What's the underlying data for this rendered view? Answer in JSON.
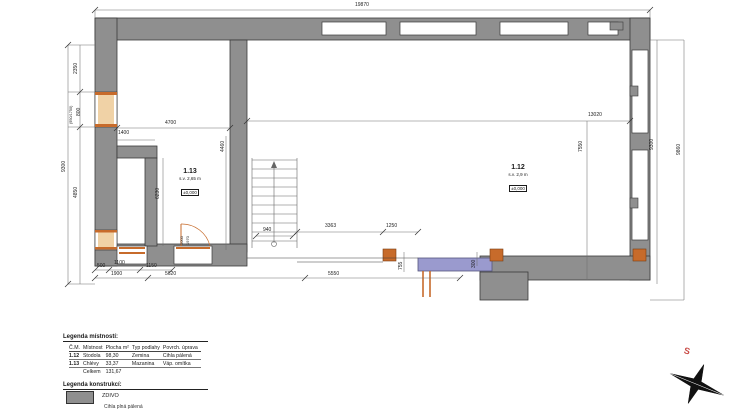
{
  "colors": {
    "wall": "#8f8f8f",
    "wall_outline": "#3a3a3a",
    "brick_accent": "#c76b2b",
    "window_fill": "#f0d2a6",
    "new_masonry_purple": "#9a9ace",
    "north_red": "#c94b46"
  },
  "rooms": [
    {
      "id": "1.13",
      "ceiling": "s.v. 2,65 m",
      "level": "±0,000"
    },
    {
      "id": "1.12",
      "ceiling": "s.v. 2,9 m",
      "level": "±0,000"
    }
  ],
  "dim_labels": [
    {
      "t": "19870",
      "x": 355,
      "y": 3
    },
    {
      "t": "9300",
      "x": 62,
      "y": 172,
      "rot": 1
    },
    {
      "t": "2350",
      "x": 74,
      "y": 74,
      "rot": 1
    },
    {
      "t": "(950/1750)",
      "x": 70,
      "y": 124,
      "rot": 1,
      "size": 3.8
    },
    {
      "t": "800",
      "x": 77,
      "y": 116,
      "rot": 1
    },
    {
      "t": "4850",
      "x": 74,
      "y": 198,
      "rot": 1
    },
    {
      "t": "4700",
      "x": 165,
      "y": 121
    },
    {
      "t": "1400",
      "x": 118,
      "y": 131
    },
    {
      "t": "13020",
      "x": 588,
      "y": 113
    },
    {
      "t": "7550",
      "x": 579,
      "y": 152,
      "rot": 1
    },
    {
      "t": "9300",
      "x": 650,
      "y": 150,
      "rot": 1
    },
    {
      "t": "9860",
      "x": 677,
      "y": 155,
      "rot": 1
    },
    {
      "t": "6230",
      "x": 156,
      "y": 199,
      "rot": 1
    },
    {
      "t": "4460",
      "x": 221,
      "y": 152,
      "rot": 1
    },
    {
      "t": "940",
      "x": 263,
      "y": 228
    },
    {
      "t": "3363",
      "x": 325,
      "y": 224
    },
    {
      "t": "1250",
      "x": 386,
      "y": 224
    },
    {
      "t": "500",
      "x": 97,
      "y": 264
    },
    {
      "t": "1100",
      "x": 114,
      "y": 261
    },
    {
      "t": "1150",
      "x": 146,
      "y": 264
    },
    {
      "t": "1900",
      "x": 111,
      "y": 272
    },
    {
      "t": "5620",
      "x": 165,
      "y": 272
    },
    {
      "t": "5550",
      "x": 328,
      "y": 272
    },
    {
      "t": "755",
      "x": 399,
      "y": 270,
      "rot": 1
    },
    {
      "t": "300",
      "x": 472,
      "y": 268,
      "rot": 1
    },
    {
      "t": "1000",
      "x": 180,
      "y": 245,
      "rot": 1,
      "size": 4
    },
    {
      "t": "1970",
      "x": 186,
      "y": 245,
      "rot": 1,
      "size": 4
    }
  ],
  "legend_rooms": {
    "title": "Legenda místností:",
    "headers": [
      "Č.M.",
      "Místnost",
      "Plocha m²",
      "Typ podlahy",
      "Povrch. úprava"
    ],
    "rows": [
      [
        "1.12",
        "Stodola",
        "98,30",
        "Zemina",
        "Cihla pálená"
      ],
      [
        "1.13",
        "Chlévy",
        "33,37",
        "Mazanina",
        "Váp. omítka"
      ]
    ],
    "total_label": "Celkem",
    "total_value": "131,67"
  },
  "legend_constructions": {
    "title": "Legenda konstrukcí:",
    "items": [
      {
        "label": "ZDIVO",
        "sub": "Cihla plná pálená"
      }
    ]
  },
  "compass": {
    "north_label": "S"
  }
}
